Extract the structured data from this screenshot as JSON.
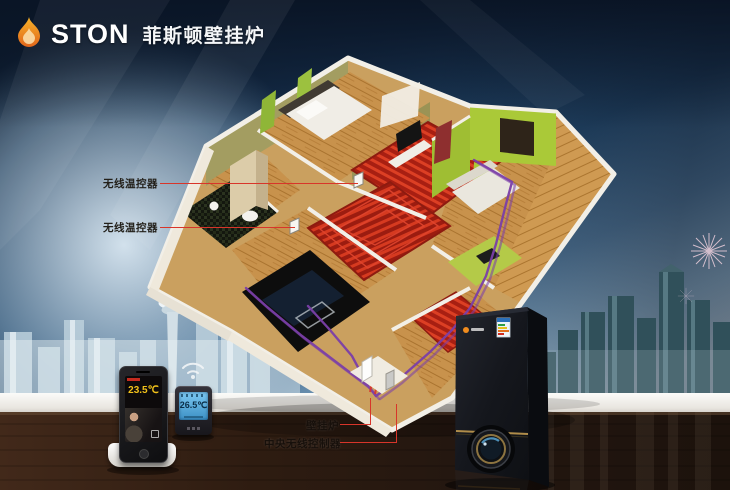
{
  "logo": {
    "brand": "STON",
    "product": "菲斯顿壁挂炉"
  },
  "annotations": {
    "wireless_thermostat_1": "无线温控器",
    "wireless_thermostat_2": "无线温控器",
    "wall_boiler": "壁挂炉",
    "central_controller": "中央无线控制器"
  },
  "devices": {
    "phone_display": {
      "temperature": "23.5℃"
    },
    "thermostat_display": {
      "temperature": "26.5℃"
    }
  },
  "colors": {
    "leader_red": "#d8352a",
    "coil_red": "#c3271a",
    "pipe_purple": "#7b3fa8",
    "wall_lime": "#a4c43e",
    "gold_trim": "#b08d4a",
    "lcd_blue": "#5fb6e8",
    "temp_yellow": "#f2c21a",
    "sky_dark": "#142c48",
    "flame_orange": "#f08c1e"
  }
}
